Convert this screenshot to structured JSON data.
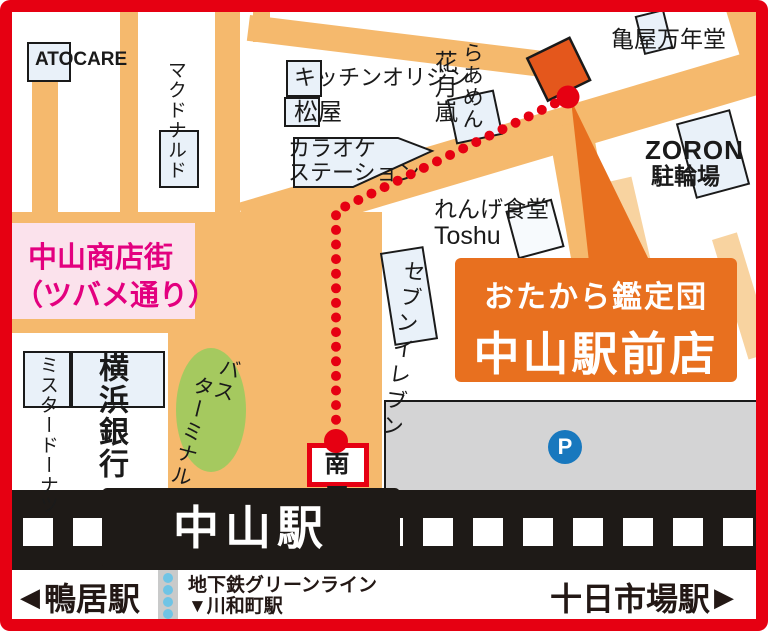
{
  "colors": {
    "frame_red": "#E60012",
    "street_orange": "#F5B96D",
    "street_light_orange": "#F8D3A0",
    "destination_orange": "#E4571C",
    "callout_orange": "#E8701F",
    "building_fill": "#E9F1F9",
    "pink_area_bg": "#FBE2EC",
    "pink_text": "#E3007F",
    "bus_green": "#A5C95F",
    "parking_gray": "#D4D4D5",
    "parking_blue": "#1878BE",
    "rail_black": "#1E1A17",
    "route_red": "#E60012",
    "subway_dot_blue": "#6FC4E5",
    "dark_text": "#231815"
  },
  "map": {
    "buildings": {
      "atocare": "ATOCARE",
      "mcdonalds": "マクドナルド",
      "kitchen_origin": "キッチンオリジン",
      "matsuya": "松屋",
      "karaoke_line1": "カラオケ",
      "karaoke_line2": "ステーション",
      "ramen_col_right": "らあめん",
      "ramen_col_left": "花月嵐",
      "kameya": "亀屋万年堂",
      "zoron": "ZORON",
      "zoron_sub": "駐輪場",
      "renge": "れんげ食堂",
      "renge_sub": "Toshu",
      "seven_eleven": "セブンイレブン",
      "mister_donut": "ミスタードーナツ",
      "yokohama_bank": "横浜銀行",
      "bus_col_right": "バス",
      "bus_col_left": "ターミナル"
    },
    "areas": {
      "shotengai_line1": "中山商店街",
      "shotengai_line2": "（ツバメ通り）",
      "parking_mark": "P"
    },
    "route": {
      "south_exit": "南口"
    },
    "callout": {
      "line1": "おたから鑑定団",
      "line2": "中山駅前店"
    },
    "station": {
      "name": "中山駅",
      "left_arrow": "◀",
      "left_station": "鴨居駅",
      "right_station": "十日市場駅",
      "right_arrow": "▶",
      "subway_line": "地下鉄グリーンライン",
      "subway_station": "▼川和町駅"
    }
  }
}
